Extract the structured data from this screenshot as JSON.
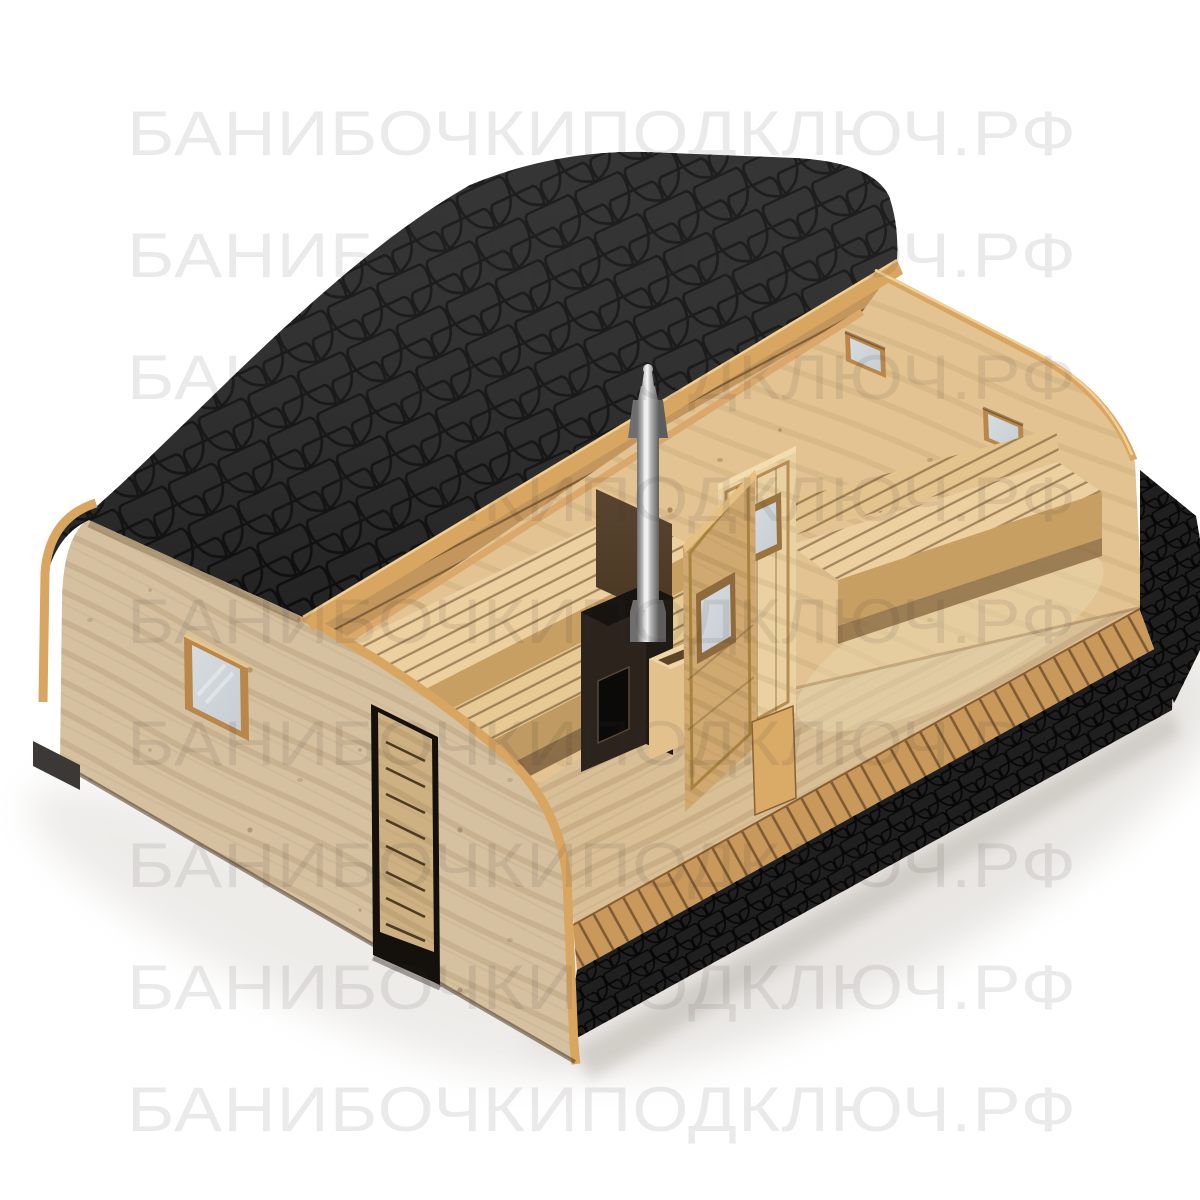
{
  "scene": {
    "description": "Cutaway 3D render of a quadro barrel sauna with black fish-scale shingle roof, pale wooden walls, interior two-tier benches, black stove with stainless chimney, partition doors with windows, black shingled base skirt and deck edge, on a white background with a repeated watermark.",
    "parts": {
      "roof": "black fish-scale shingle barrel roof",
      "roof_edge_board": "tan roof cut-edge board",
      "front_wall": "pale wooden front wall",
      "front_window": "square window with gray glazing",
      "front_door": "wooden entrance door with black trim and horizontal slats",
      "end_wall": "rounded-corner end wall with two small windows",
      "interior_benches": "two-tier slatted sauna benches",
      "stove": "black sauna stove with firebox door",
      "stove_shield": "dark heat-shield panel behind stove",
      "chimney": "stainless steel chimney with rain cap",
      "partition_doors": "two interior partition doors with small windows",
      "water_tank": "wooden water tank box beside stove",
      "terrace_bench": "bench along the end wall",
      "skirt": "black shingled base skirt",
      "deck": "plank deck edge with slat gaps",
      "ceiling": "slatted ceiling band under the roof cut"
    }
  },
  "watermark": {
    "text": "БАНИБОЧКИПОДКЛЮЧ.РФ",
    "rows": 9,
    "row_spacing_px": 122
  },
  "colors": {
    "bg": "#ffffff",
    "watermark": "rgba(55,50,45,0.10)",
    "roof_base": "#242424",
    "roof_line": "#0b0b0b",
    "edge_board": "#d8a660",
    "edge_board_light": "#f2d094",
    "wall_front": "#d5c1a0",
    "wall_warm": "#e3c392",
    "floor_wood": "#d9bf96",
    "bench_top": "#ecd0a0",
    "bench_face": "#c79f63",
    "ceiling_wood": "#c2965c",
    "deck_wood": "#c9995c",
    "skirt_black": "#1f1f1f",
    "frame_wood": "#b9874a",
    "glass": "#c7ced4",
    "stove_dark": "#2b231c",
    "stove_panel": "#46341f",
    "metal_light": "#f4f4f4",
    "metal_dark": "#5d5d5d",
    "shadow": "#cfcac3"
  }
}
